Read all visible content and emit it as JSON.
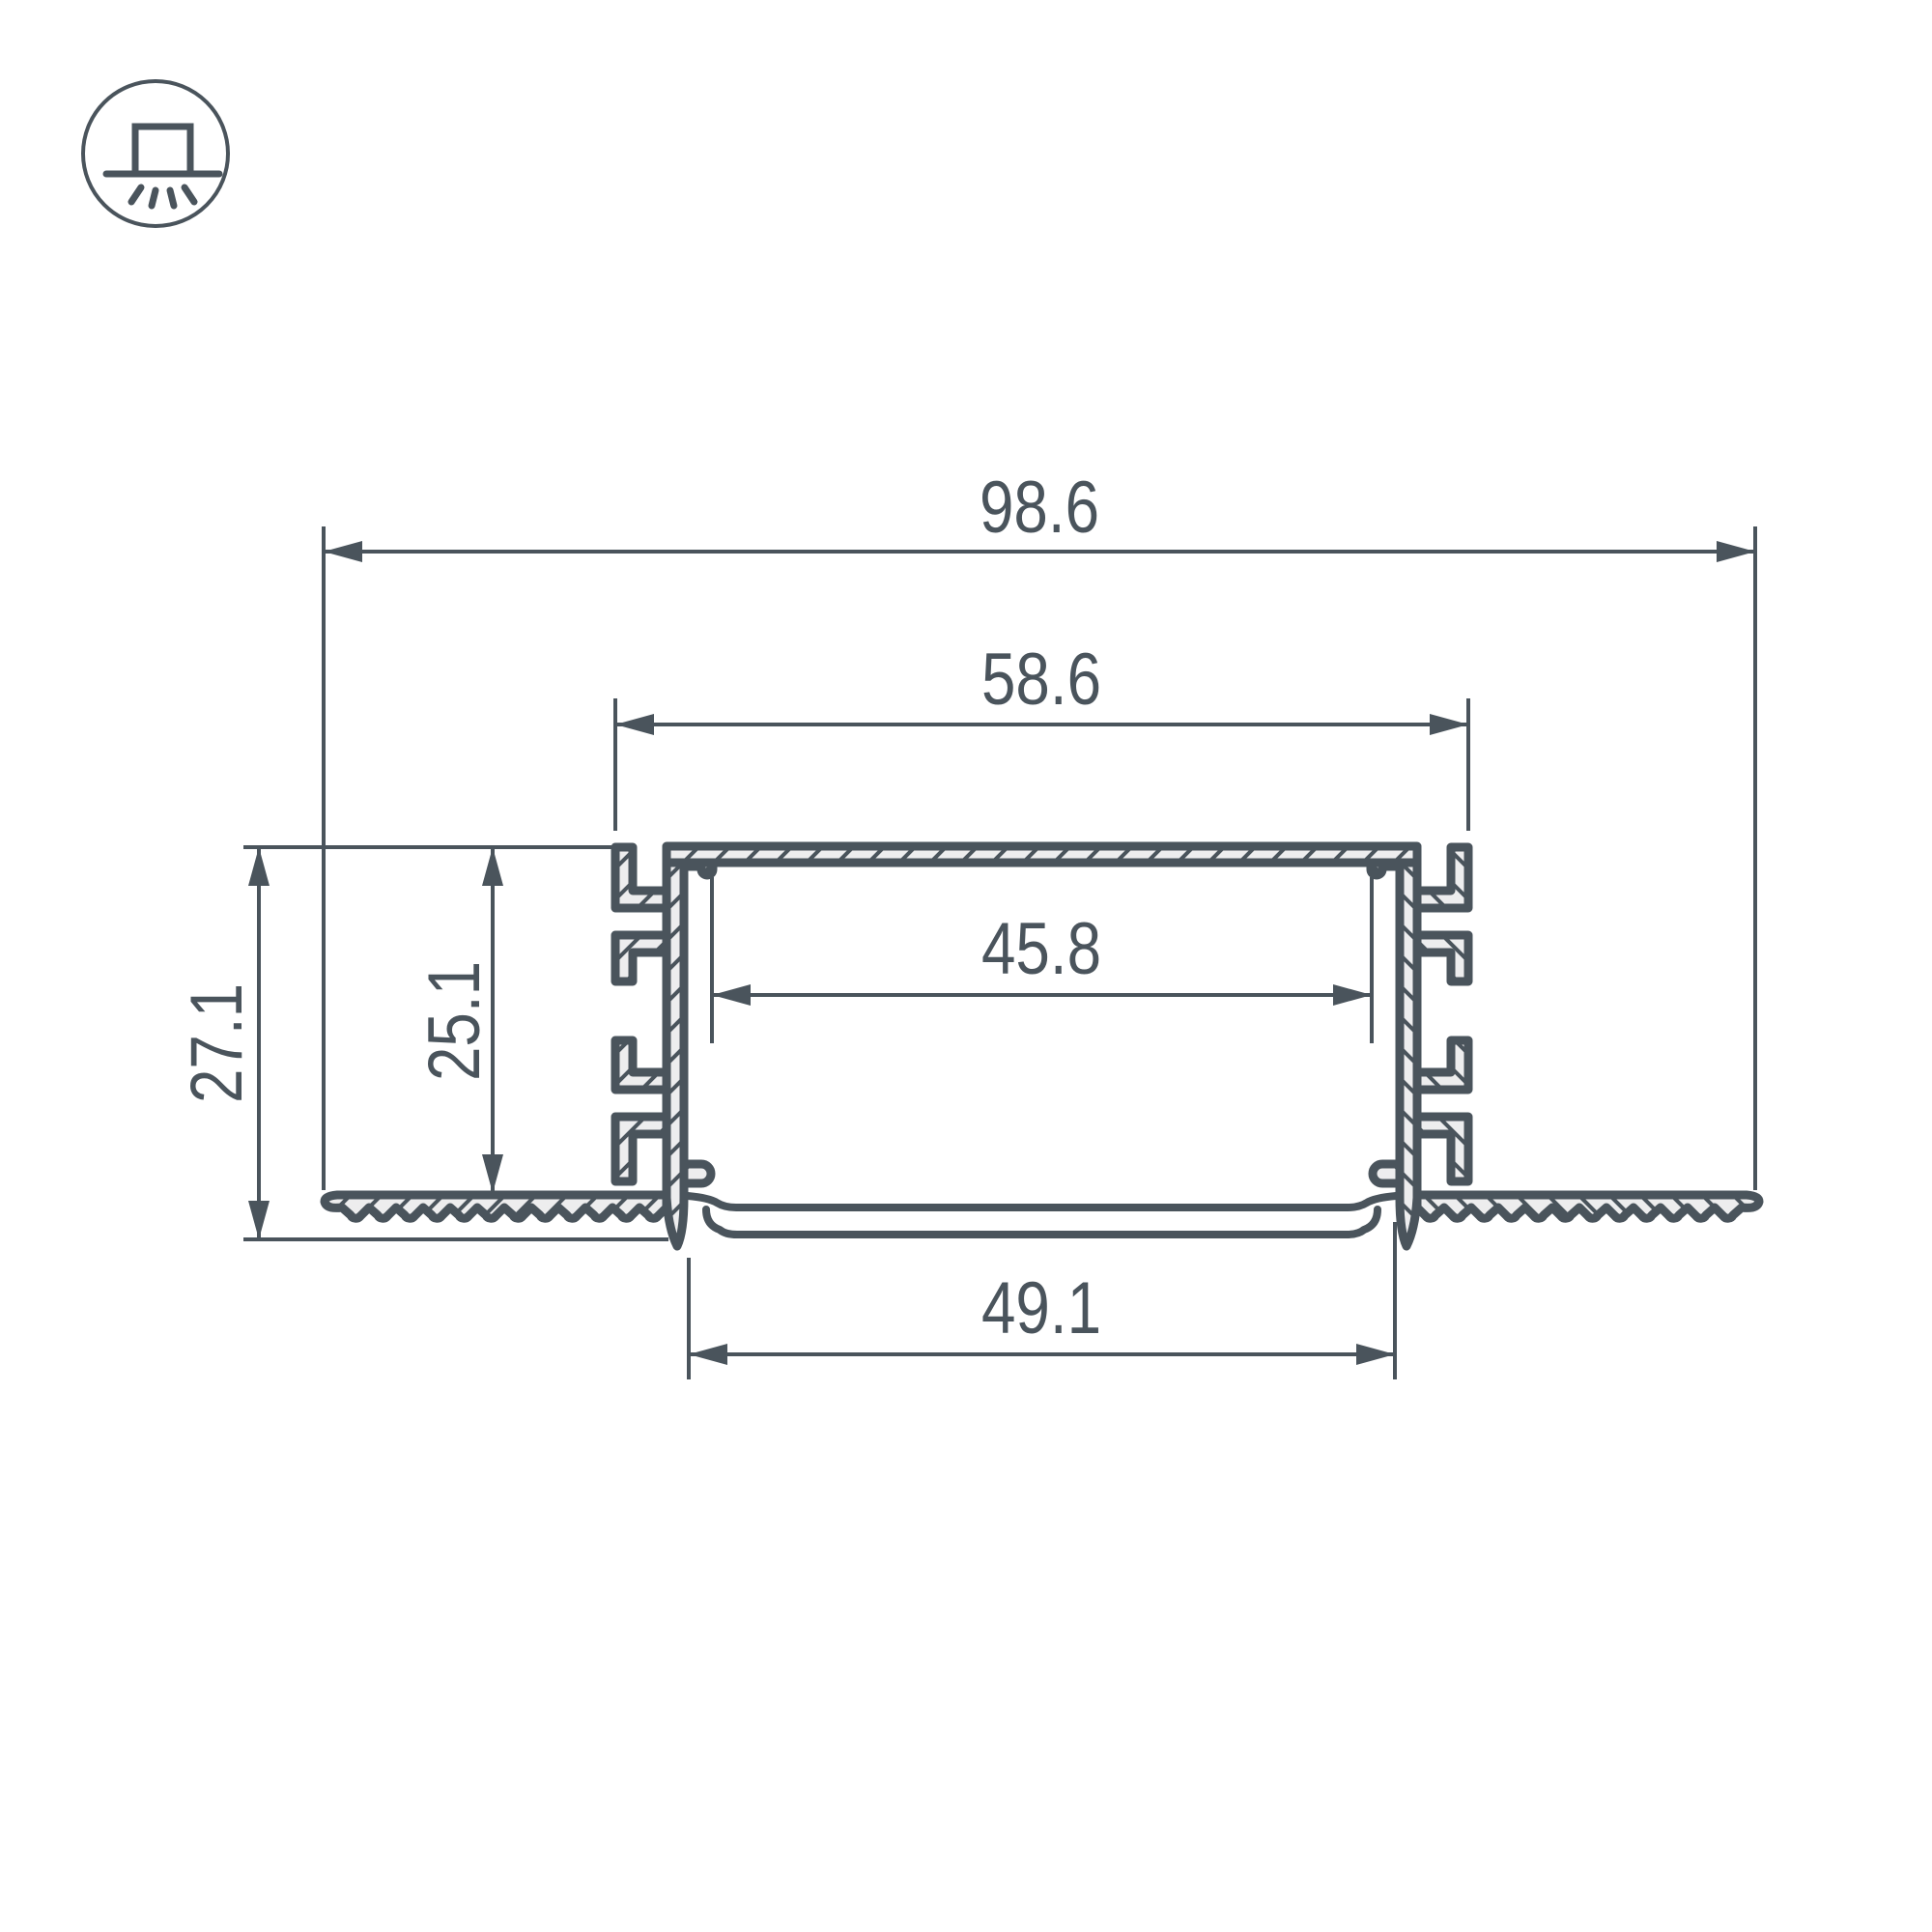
{
  "icon": {
    "type": "recessed-mount-luminaire"
  },
  "colors": {
    "line": "#4a545c",
    "material_fill": "#ededee",
    "background": "#ffffff"
  },
  "dimensions": {
    "total_width": "98.6",
    "body_width": "58.6",
    "inner_width": "45.8",
    "bottom_width": "49.1",
    "total_height": "27.1",
    "inner_height": "25.1"
  }
}
